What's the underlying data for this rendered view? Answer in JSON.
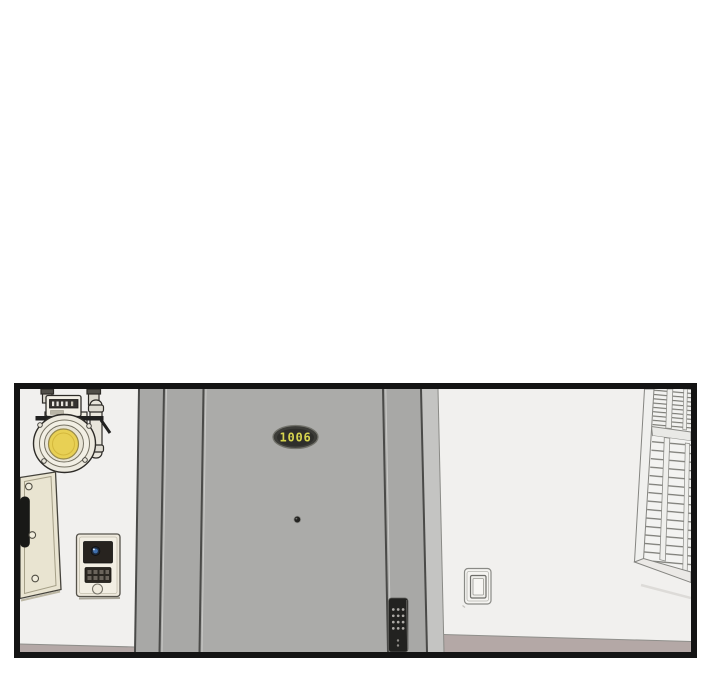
{
  "panel": {
    "type": "webtoon-scene-panel",
    "door_number": "1006",
    "objects": [
      "gas-meter",
      "utility-panel-door",
      "video-intercom",
      "apartment-door",
      "door-number-plate",
      "peephole",
      "digital-door-lock",
      "light-switch",
      "louver-window",
      "floor-baseboard"
    ],
    "colors": {
      "background": "#ffffff",
      "border": "#141414",
      "wall": "#f1f0ee",
      "door": "#ababa9",
      "door_frame": "#a8a8a6",
      "frame_light_strip": "#c4c4c2",
      "seam": "#4a4a48",
      "floor": "#b4a8a6",
      "plate": "#3c3c38",
      "plate_text": "#d6d44f",
      "meter_dial": "#e8d054",
      "lens": "#3f6fae"
    }
  }
}
